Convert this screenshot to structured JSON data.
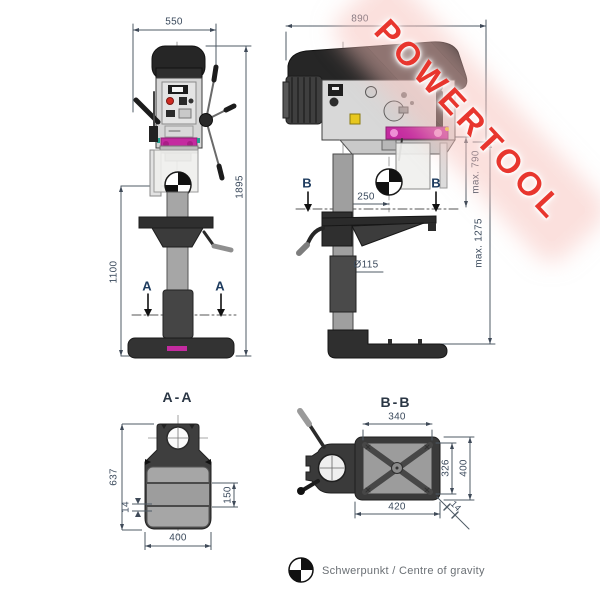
{
  "watermark": {
    "text": "POWERTOOL",
    "color": "#e8362e"
  },
  "front_view": {
    "dim_width": "550",
    "dim_total_height": "1895",
    "dim_column_height": "1100",
    "section_label_left": "A",
    "section_label_right": "A"
  },
  "side_view": {
    "dim_depth": "890",
    "dim_throat": "250",
    "dim_max_stroke": "max. 790",
    "dim_max_table": "max. 1275",
    "dim_column_diameter": "Ø115",
    "section_label_left": "B",
    "section_label_right": "B"
  },
  "section_aa": {
    "title": "A-A",
    "dim_height": "637",
    "dim_width": "400",
    "dim_inner": "150",
    "dim_rib": "14"
  },
  "section_bb": {
    "title": "B-B",
    "dim_top": "340",
    "dim_inner_height": "326",
    "dim_outer_height": "400",
    "dim_bottom": "420",
    "dim_thickness": "14"
  },
  "legend": {
    "text": "Schwerpunkt / Centre of gravity"
  },
  "colors": {
    "magenta": "#c42ba0",
    "dark": "#2b2b2b",
    "dim_line": "#4f5b66"
  }
}
